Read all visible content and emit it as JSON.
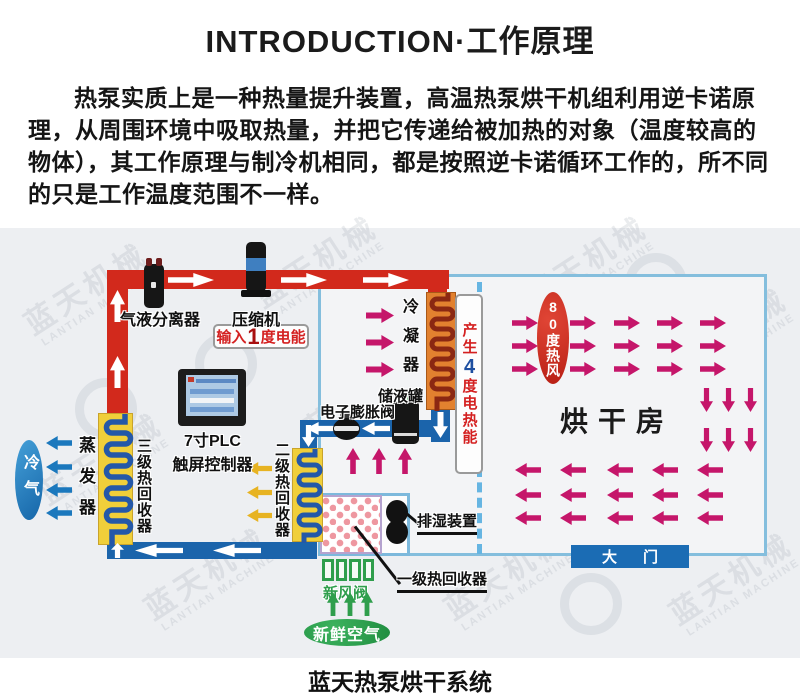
{
  "header": {
    "title": "INTRODUCTION·工作原理",
    "paragraph": "热泵实质上是一种热量提升装置，高温热泵烘干机组利用逆卡诺原理，从周围环境中吸取热量，并把它传递给被加热的对象（温度较高的物体），其工作原理与制冷机相同，都是按照逆卡诺循环工作的，所不同的只是工作温度范围不一样。"
  },
  "diagram": {
    "caption": "蓝天热泵烘干系统",
    "watermark_cn": "蓝天机械",
    "watermark_en": "LANTIAN MACHINE",
    "labels": {
      "separator": "气液分离器",
      "compressor": "压缩机",
      "input_prefix": "输入",
      "input_big": "1",
      "input_suffix": "度电能",
      "condenser": "冷凝器",
      "produce_prefix": "产生",
      "produce_big": "4",
      "produce_suffix": "度电热能",
      "tank": "储液罐",
      "expansion_valve": "电子膨胀阀",
      "plc_line1": "7寸PLC",
      "plc_line2": "触屏控制器",
      "stage3": "三级热回收器",
      "evaporator": "蒸发器",
      "cold_air": "冷气",
      "stage2": "二级热回收器",
      "stage1": "一级热回收器",
      "dehumidifier": "排湿装置",
      "fresh_valve": "新风阀",
      "fresh_air": "新鲜空气",
      "hot_wind": "80度热风",
      "drying_room": "烘干房",
      "gate": "大门"
    },
    "colors": {
      "hot_pipe": "#d2291c",
      "cold_pipe": "#1b64ab",
      "airflow_hot": "#c5166a",
      "airflow_cold": "#1b78bd",
      "airflow_recovered": "#e7b322",
      "airflow_fresh": "#2f9e4c",
      "enclosure_border": "#84bedd",
      "gate_bg": "#1b6cb4"
    }
  }
}
